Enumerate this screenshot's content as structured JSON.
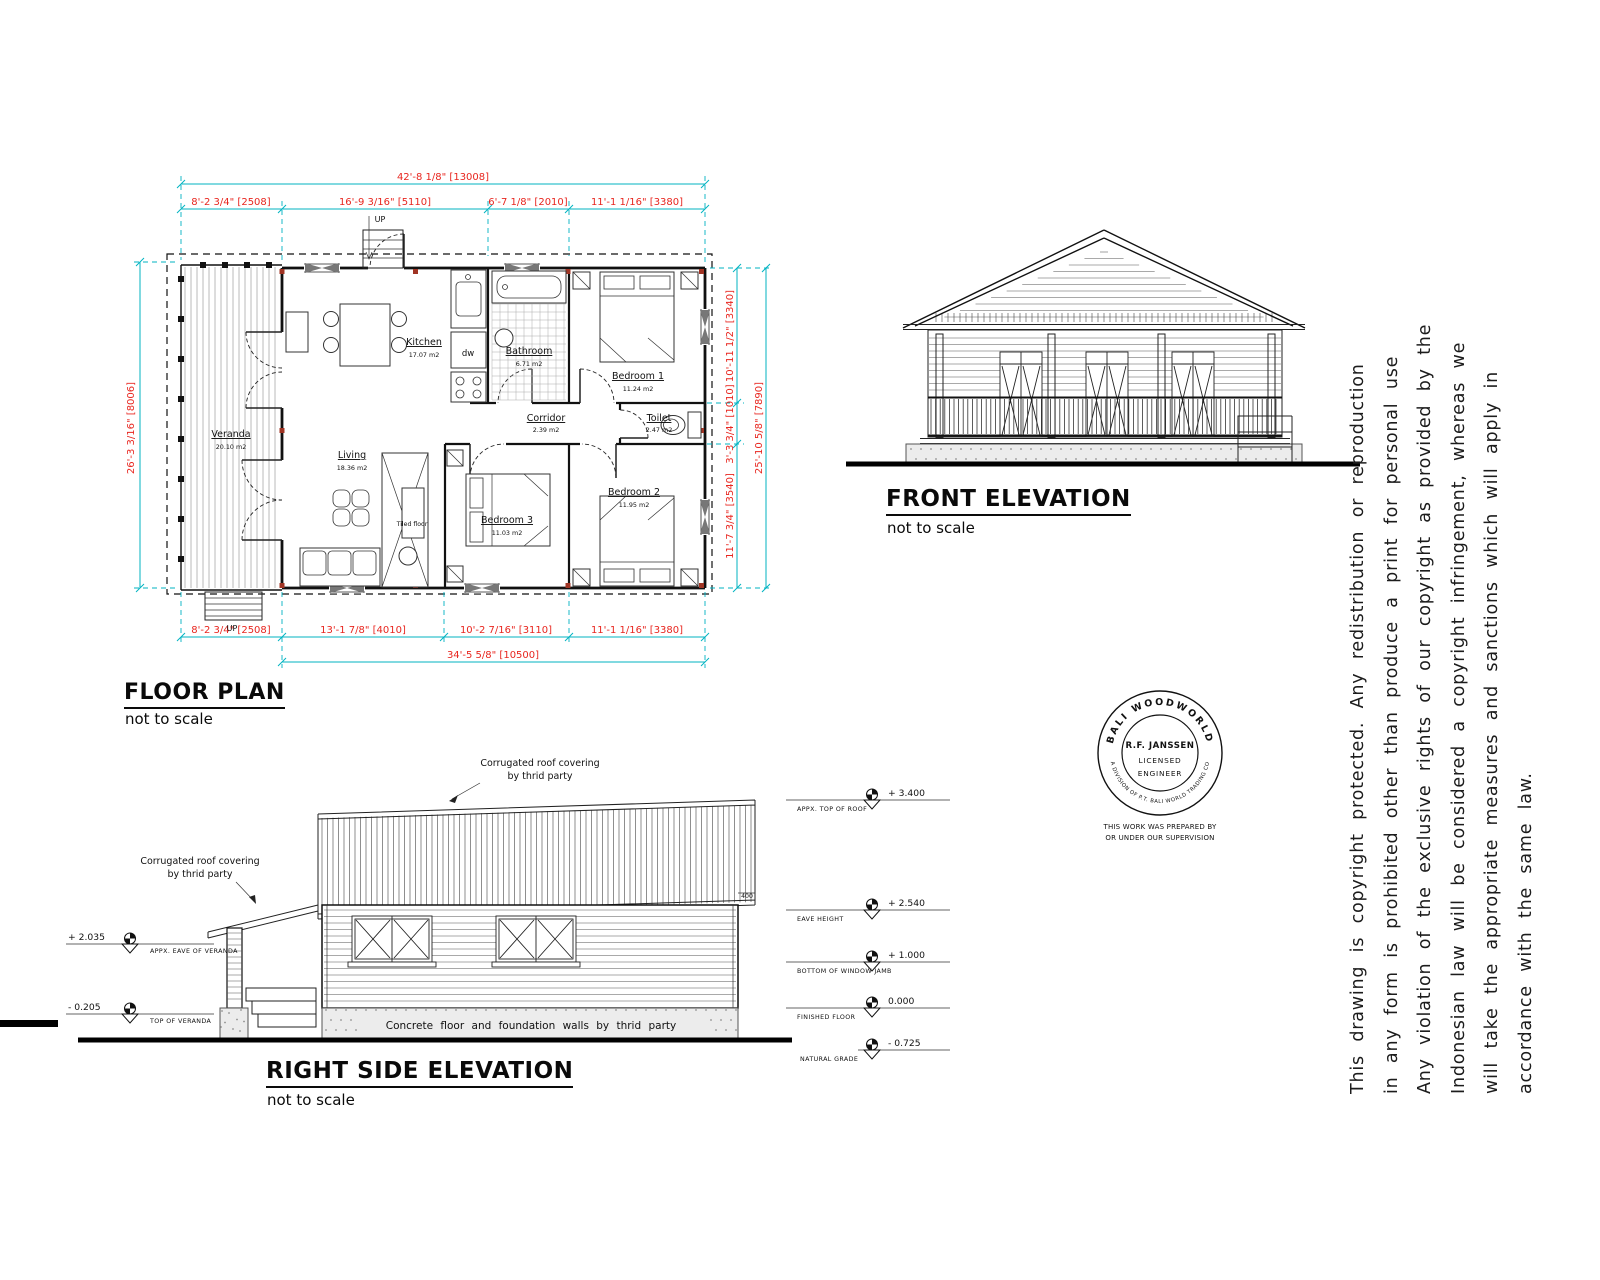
{
  "colors": {
    "dim_line": "#00b3c2",
    "dim_text": "#e8261f"
  },
  "floor_plan": {
    "title": "FLOOR PLAN",
    "subtitle": "not to scale",
    "dim_top_overall": "42'-8 1/8\" [13008]",
    "dim_top_segments": [
      "8'-2 3/4\" [2508]",
      "16'-9 3/16\" [5110]",
      "6'-7 1/8\" [2010]",
      "11'-1 1/16\" [3380]"
    ],
    "dim_left": "26'-3 3/16\" [8006]",
    "dim_right_segments": [
      "10'-11 1/2\" [3340]",
      "3'-3 3/4\" [1010]",
      "11'-7 3/4\" [3540]"
    ],
    "dim_right_overall": "25'-10 5/8\" [7890]",
    "dim_bottom_segments": [
      "8'-2 3/4\" [2508]",
      "13'-1 7/8\" [4010]",
      "10'-2 7/16\" [3110]",
      "11'-1 1/16\" [3380]"
    ],
    "dim_bottom_overall": "34'-5 5/8\" [10500]",
    "rooms": {
      "veranda": {
        "name": "Veranda",
        "area": "20.10 m2"
      },
      "kitchen": {
        "name": "Kitchen",
        "area": "17.07 m2"
      },
      "bathroom": {
        "name": "Bathroom",
        "area": "6.71 m2"
      },
      "bedroom1": {
        "name": "Bedroom 1",
        "area": "11.24 m2"
      },
      "corridor": {
        "name": "Corridor",
        "area": "2.39 m2"
      },
      "toilet": {
        "name": "Toilet",
        "area": "2.47 m2"
      },
      "living": {
        "name": "Living",
        "area": "18.36 m2"
      },
      "bedroom3": {
        "name": "Bedroom 3",
        "area": "11.03 m2"
      },
      "bedroom2": {
        "name": "Bedroom 2",
        "area": "11.95 m2"
      }
    },
    "labels": {
      "up_top": "UP",
      "up_bottom": "UP",
      "dw": "dw",
      "tiled_floor": "Tiled floor"
    }
  },
  "front_elevation": {
    "title": "FRONT ELEVATION",
    "subtitle": "not to scale"
  },
  "side_elevation": {
    "title": "RIGHT SIDE ELEVATION",
    "subtitle": "not to scale",
    "roof_note_line1": "Corrugated roof covering",
    "roof_note_line2": "by thrid party",
    "veranda_roof_note_line1": "Corrugated roof covering",
    "veranda_roof_note_line2": "by thrid party",
    "foundation_note": "Concrete floor and foundation walls by thrid party",
    "eave_overhang_dim": "400",
    "levels_right": [
      {
        "value": "+ 3.400",
        "label": "APPX. TOP OF ROOF"
      },
      {
        "value": "+ 2.540",
        "label": "EAVE HEIGHT"
      },
      {
        "value": "+ 1.000",
        "label": "BOTTOM OF WINDOW JAMB"
      },
      {
        "value": "0.000",
        "label": "FINISHED FLOOR"
      },
      {
        "value": "- 0.725",
        "label": "NATURAL GRADE"
      }
    ],
    "levels_left": [
      {
        "value": "+ 2.035",
        "label": "APPX. EAVE OF VERANDA"
      },
      {
        "value": "- 0.205",
        "label": "TOP OF VERANDA"
      }
    ]
  },
  "stamp": {
    "arc_top": "BALI WOODWORLD",
    "arc_bottom": "A DIVISION OF P.T. BALI WORLD TRADING CO",
    "name": "R.F. JANSSEN",
    "line2": "LICENSED",
    "line3": "ENGINEER",
    "note_line1": "THIS WORK WAS PREPARED BY",
    "note_line2": "OR UNDER OUR SUPERVISION"
  },
  "copyright": {
    "lines": [
      "This drawing is copyright protected. Any redistribution or reproduction",
      "in any form is prohibited other than produce a print for personal use",
      "Any violation of the exclusive rights of our copyright as provided by the",
      "Indonesian law will be considered a copyright infringement, whereas we",
      "will take the appropriate measures and sanctions which will apply in",
      "accordance with the same law."
    ]
  }
}
